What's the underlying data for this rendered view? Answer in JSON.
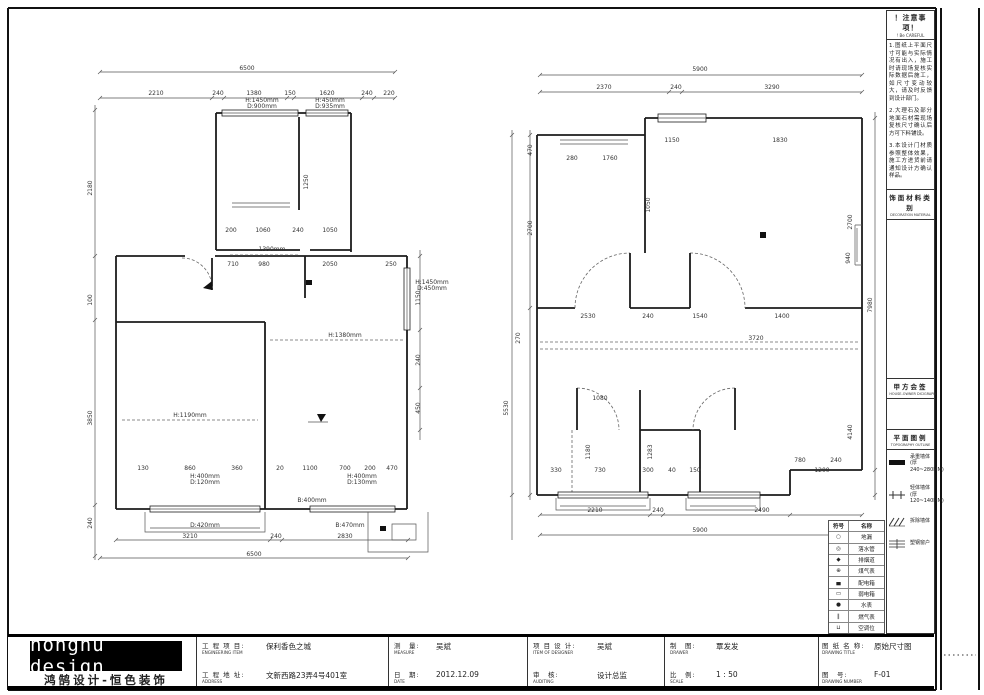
{
  "titlebar": {
    "logo_en": "honghu design",
    "logo_cn": "鸿鹄设计-恒色装饰",
    "project_label": "工 程 项 目:",
    "project_en": "ENGINEERING ITEM",
    "project_value": "保利香色之城",
    "address_label": "工 程 地 址:",
    "address_en": "ADDRESS",
    "address_value": "文新西路23弄4号401室",
    "measure_label": "测　量:",
    "measure_en": "MEASURE",
    "measure_value": "吴斌",
    "date_label": "日　期:",
    "date_en": "DATE",
    "date_value": "2012.12.09",
    "designer_label": "项 目 设 计:",
    "designer_en": "ITEM OF DESIGNER",
    "designer_value": "吴斌",
    "audit_label": "审　核:",
    "audit_en": "AUDITING",
    "audit_value": "设计总监",
    "drawer_label": "制　图:",
    "drawer_en": "DRAWER",
    "drawer_value": "覃发发",
    "scale_label": "比　例:",
    "scale_en": "SCALE",
    "scale_value": "1 : 50",
    "title_label": "图 纸 名 称:",
    "title_en": "DRAWING TITLE",
    "title_value": "原始尺寸图",
    "number_label": "图　号:",
    "number_en": "DRAWING NUMBER",
    "number_value": "F-01"
  },
  "right_panel": {
    "notes_title": "！注意事项！",
    "notes_sub": "! Be CAREFUL",
    "notes": [
      "1.图纸上平面尺寸可能与实际情况有出入，施工时请现场复核实际数据后施工，如尺寸变动较大，请及时反馈到设计部门。",
      "2.大理石及部分地面石材需现场复核尺寸确认后方可下料铺设。",
      "3.本设计门材质参照整体效果，施工方进货前请通知设计方确认样品。"
    ],
    "material_title": "饰面材料类别",
    "material_sub": "DECORATION MATERIAL",
    "sign_title": "甲方会签",
    "sign_sub": "HOUSE-OWNER DICIGRAPH",
    "legend_title": "平面图例",
    "legend_sub": "TOPOGRAPHY OUTLINE",
    "legend": [
      {
        "name": "承重墙体",
        "spec": "(厚240~280MM)"
      },
      {
        "name": "轻体墙体",
        "spec": "(厚120~140MM)"
      },
      {
        "name": "拆除墙体",
        "spec": ""
      },
      {
        "name": "塑钢窗户",
        "spec": ""
      }
    ],
    "line_color": "#1c1c1c"
  },
  "symbol_table": {
    "rows": [
      [
        "符号",
        "名称"
      ],
      [
        "○",
        "地漏"
      ],
      [
        "◎",
        "落水管"
      ],
      [
        "◆",
        "排烟道"
      ],
      [
        "⊕",
        "煤气表"
      ],
      [
        "▄",
        "配电箱"
      ],
      [
        "▭",
        "弱电箱"
      ],
      [
        "●",
        "水表"
      ],
      [
        "∥",
        "燃气表"
      ],
      [
        "⊔",
        "空调位"
      ]
    ]
  },
  "plans": {
    "left": {
      "labels": [
        {
          "x": 247,
          "y": 70,
          "t": "6500"
        },
        {
          "x": 156,
          "y": 95,
          "t": "2210"
        },
        {
          "x": 218,
          "y": 95,
          "t": "240"
        },
        {
          "x": 254,
          "y": 95,
          "t": "1380"
        },
        {
          "x": 290,
          "y": 95,
          "t": "150"
        },
        {
          "x": 327,
          "y": 95,
          "t": "1620"
        },
        {
          "x": 367,
          "y": 95,
          "t": "240"
        },
        {
          "x": 389,
          "y": 95,
          "t": "220"
        },
        {
          "x": 262,
          "y": 102,
          "t": "H:1450mm",
          "s": 5.2
        },
        {
          "x": 262,
          "y": 108,
          "t": "D:900mm",
          "s": 5.2
        },
        {
          "x": 330,
          "y": 102,
          "t": "H:450mm",
          "s": 5.2
        },
        {
          "x": 330,
          "y": 108,
          "t": "D:935mm",
          "s": 5.2
        },
        {
          "x": 231,
          "y": 232,
          "t": "200"
        },
        {
          "x": 263,
          "y": 232,
          "t": "1060"
        },
        {
          "x": 298,
          "y": 232,
          "t": "240"
        },
        {
          "x": 330,
          "y": 232,
          "t": "1050"
        },
        {
          "x": 308,
          "y": 182,
          "t": "1250",
          "r": -90
        },
        {
          "x": 233,
          "y": 266,
          "t": "710"
        },
        {
          "x": 264,
          "y": 266,
          "t": "980"
        },
        {
          "x": 330,
          "y": 266,
          "t": "2050"
        },
        {
          "x": 391,
          "y": 266,
          "t": "250"
        },
        {
          "x": 272,
          "y": 251,
          "t": "1390mm",
          "s": 5.2
        },
        {
          "x": 345,
          "y": 337,
          "t": "H:1380mm",
          "s": 5.2
        },
        {
          "x": 190,
          "y": 417,
          "t": "H:1190mm",
          "s": 5.2
        },
        {
          "x": 92,
          "y": 188,
          "t": "2180",
          "r": -90
        },
        {
          "x": 92,
          "y": 300,
          "t": "100",
          "r": -90
        },
        {
          "x": 92,
          "y": 418,
          "t": "3850",
          "r": -90
        },
        {
          "x": 92,
          "y": 523,
          "t": "240",
          "r": -90
        },
        {
          "x": 420,
          "y": 298,
          "t": "1150",
          "r": -90
        },
        {
          "x": 420,
          "y": 360,
          "t": "240",
          "r": -90
        },
        {
          "x": 420,
          "y": 408,
          "t": "450",
          "r": -90
        },
        {
          "x": 432,
          "y": 284,
          "t": "H:1450mm",
          "s": 5.2
        },
        {
          "x": 432,
          "y": 290,
          "t": "D:450mm",
          "s": 5.2
        },
        {
          "x": 143,
          "y": 470,
          "t": "130"
        },
        {
          "x": 190,
          "y": 470,
          "t": "860"
        },
        {
          "x": 237,
          "y": 470,
          "t": "360"
        },
        {
          "x": 280,
          "y": 470,
          "t": "20"
        },
        {
          "x": 310,
          "y": 470,
          "t": "1100"
        },
        {
          "x": 345,
          "y": 470,
          "t": "700"
        },
        {
          "x": 370,
          "y": 470,
          "t": "200"
        },
        {
          "x": 392,
          "y": 470,
          "t": "470"
        },
        {
          "x": 205,
          "y": 478,
          "t": "H:400mm",
          "s": 5.2
        },
        {
          "x": 205,
          "y": 484,
          "t": "D:120mm",
          "s": 5.2
        },
        {
          "x": 362,
          "y": 478,
          "t": "H:400mm",
          "s": 5.2
        },
        {
          "x": 362,
          "y": 484,
          "t": "D:130mm",
          "s": 5.2
        },
        {
          "x": 312,
          "y": 502,
          "t": "B:400mm",
          "s": 5.2
        },
        {
          "x": 205,
          "y": 527,
          "t": "D:420mm",
          "s": 5.2
        },
        {
          "x": 350,
          "y": 527,
          "t": "B:470mm",
          "s": 5.2
        },
        {
          "x": 190,
          "y": 538,
          "t": "3210"
        },
        {
          "x": 276,
          "y": 538,
          "t": "240"
        },
        {
          "x": 345,
          "y": 538,
          "t": "2830"
        },
        {
          "x": 254,
          "y": 556,
          "t": "6500"
        }
      ]
    },
    "right": {
      "labels": [
        {
          "x": 700,
          "y": 71,
          "t": "5900"
        },
        {
          "x": 604,
          "y": 89,
          "t": "2370"
        },
        {
          "x": 676,
          "y": 89,
          "t": "240"
        },
        {
          "x": 772,
          "y": 89,
          "t": "3290"
        },
        {
          "x": 572,
          "y": 160,
          "t": "280"
        },
        {
          "x": 610,
          "y": 160,
          "t": "1760"
        },
        {
          "x": 672,
          "y": 142,
          "t": "1150"
        },
        {
          "x": 780,
          "y": 142,
          "t": "1830"
        },
        {
          "x": 852,
          "y": 222,
          "t": "2700",
          "r": -90
        },
        {
          "x": 650,
          "y": 205,
          "t": "1050",
          "r": -90
        },
        {
          "x": 588,
          "y": 318,
          "t": "2530"
        },
        {
          "x": 648,
          "y": 318,
          "t": "240"
        },
        {
          "x": 700,
          "y": 318,
          "t": "1540"
        },
        {
          "x": 782,
          "y": 318,
          "t": "1400"
        },
        {
          "x": 756,
          "y": 340,
          "t": "3720",
          "s": 5.2
        },
        {
          "x": 532,
          "y": 150,
          "t": "470",
          "r": -90
        },
        {
          "x": 532,
          "y": 228,
          "t": "2700",
          "r": -90
        },
        {
          "x": 520,
          "y": 338,
          "t": "270",
          "r": -90
        },
        {
          "x": 508,
          "y": 408,
          "t": "5530",
          "r": -90
        },
        {
          "x": 872,
          "y": 305,
          "t": "7980",
          "r": -90
        },
        {
          "x": 850,
          "y": 258,
          "t": "940",
          "r": -90
        },
        {
          "x": 852,
          "y": 432,
          "t": "4140",
          "r": -90
        },
        {
          "x": 600,
          "y": 400,
          "t": "1080"
        },
        {
          "x": 590,
          "y": 452,
          "t": "1180",
          "r": -90
        },
        {
          "x": 652,
          "y": 452,
          "t": "1283",
          "r": -90
        },
        {
          "x": 556,
          "y": 472,
          "t": "330"
        },
        {
          "x": 600,
          "y": 472,
          "t": "730"
        },
        {
          "x": 648,
          "y": 472,
          "t": "300"
        },
        {
          "x": 672,
          "y": 472,
          "t": "40"
        },
        {
          "x": 695,
          "y": 472,
          "t": "150"
        },
        {
          "x": 800,
          "y": 462,
          "t": "780",
          "s": 5.2
        },
        {
          "x": 836,
          "y": 462,
          "t": "240",
          "s": 5.2
        },
        {
          "x": 822,
          "y": 472,
          "t": "1200"
        },
        {
          "x": 595,
          "y": 512,
          "t": "2210"
        },
        {
          "x": 658,
          "y": 512,
          "t": "240"
        },
        {
          "x": 762,
          "y": 512,
          "t": "2490"
        },
        {
          "x": 700,
          "y": 532,
          "t": "5900"
        }
      ]
    }
  }
}
